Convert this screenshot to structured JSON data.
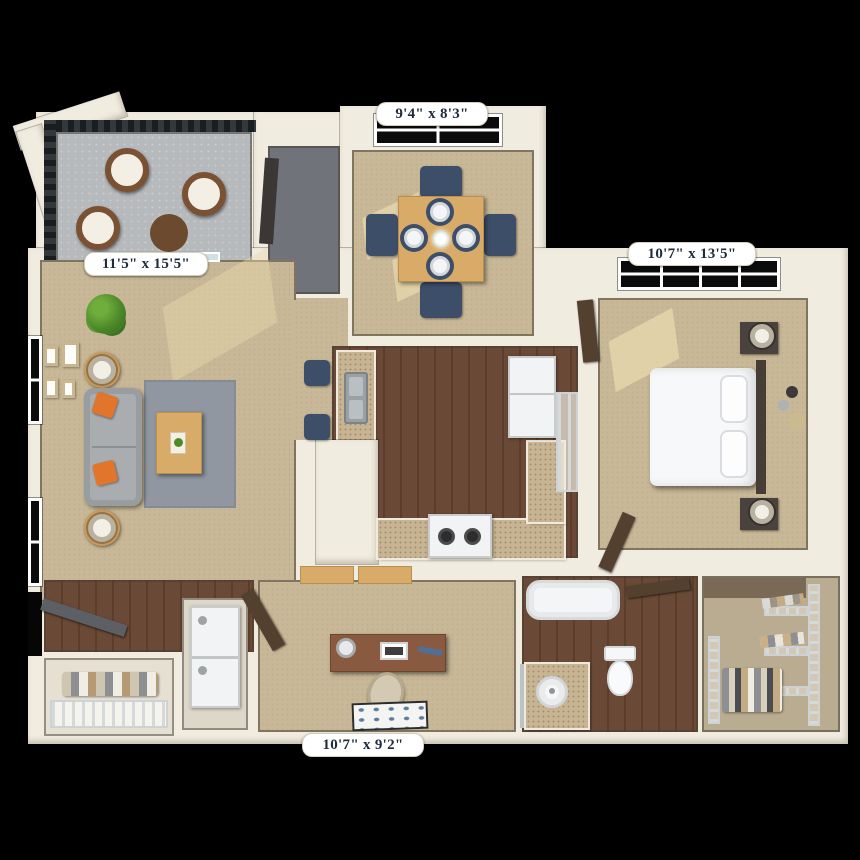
{
  "scene": {
    "type": "3D apartment floor plan, top-down render",
    "background": "#000000"
  },
  "colors": {
    "background": "#000000",
    "wall": "#f1ece0",
    "carpet": "#c8b897",
    "sunlight": "#e9d9ae",
    "wood_floor": "#6a4936",
    "wood_floor_dark": "#5c3d2b",
    "balcony_floor": "#b7babd",
    "utility_floor": "#70747a",
    "counter": "#c6b493",
    "counter_speck": "#a68f6f",
    "navy": "#3d4e68",
    "sofa_gray": "#aaadb0",
    "accent_orange": "#e0752b",
    "rug_gray": "#9097a1",
    "oak": "#d9ab69",
    "desk_wood": "#8a5a40",
    "door_brown": "#53402f",
    "railing": "#33383d",
    "appliance": "#f2f3f4",
    "closet_carpet": "#b9ac90",
    "label_bg": "#ffffff",
    "label_text": "#1d2b3c"
  },
  "rooms": {
    "dining": {
      "name": "Dining Room",
      "dimensions": "9'4\" x 8'3\"",
      "floor": "carpet",
      "contents": [
        "square oak dining table",
        "4 navy dining chairs",
        "4 white place settings on navy placemats",
        "white floral centerpiece",
        "4-pane window",
        "sunlight patches"
      ]
    },
    "bedroom": {
      "name": "Bedroom",
      "dimensions": "10'7\" x 13'5\"",
      "floor": "carpet",
      "contents": [
        "bed with white bedding and 2 pillows",
        "dark headboard",
        "2 dark nightstands with lamps",
        "3-circle wall decor",
        "8-pane window",
        "sunlight patches",
        "open brown door"
      ]
    },
    "living": {
      "name": "Living Room",
      "dimensions": "11'5\" x 15'5\"",
      "floor": "carpet",
      "contents": [
        "gray sofa with 2 orange throw pillows",
        "gray area rug",
        "oak coffee table",
        "2 round end tables with lamps",
        "potted plant",
        "4 picture frames",
        "2 windows",
        "sliding glass door to balcony"
      ]
    },
    "den": {
      "name": "Den / Office",
      "dimensions": "10'7\" x 9'2\"",
      "floor": "carpet",
      "contents": [
        "wood desk with monitor, lamp and papers",
        "desk chair",
        "navy-dotted accent rug",
        "open door",
        "closet shelves"
      ]
    },
    "kitchen": {
      "name": "Kitchen",
      "floor": "dark wood plank",
      "contents": [
        "U-shaped speckled granite counter",
        "double-basin sink",
        "white range with 2 burners",
        "white refrigerator",
        "wire pantry shelves",
        "2 navy bar stools"
      ]
    },
    "bathroom": {
      "name": "Bathroom",
      "floor": "dark wood plank",
      "contents": [
        "bathtub",
        "toilet",
        "granite vanity with round sink",
        "mirror",
        "open brown door"
      ]
    },
    "balcony": {
      "name": "Balcony / Patio",
      "floor": "concrete",
      "contents": [
        "3 round wicker chairs with white cushions",
        "round wicker side table",
        "dark lattice railing",
        "white corner column"
      ]
    },
    "walkin_closet": {
      "name": "Walk-in Closet",
      "floor": "carpet",
      "contents": [
        "wire shelving racks",
        "hanging and folded clothes"
      ]
    },
    "entry": {
      "name": "Entry",
      "floor": "dark wood plank",
      "contents": [
        "open front door",
        "coat closet with wire shelf and clothes"
      ]
    },
    "laundry": {
      "name": "Laundry Closet",
      "contents": [
        "stacked washer and dryer"
      ]
    },
    "utility": {
      "name": "Utility Closet",
      "floor": "dark gray",
      "contents": [
        "dark equipment panel"
      ]
    }
  }
}
